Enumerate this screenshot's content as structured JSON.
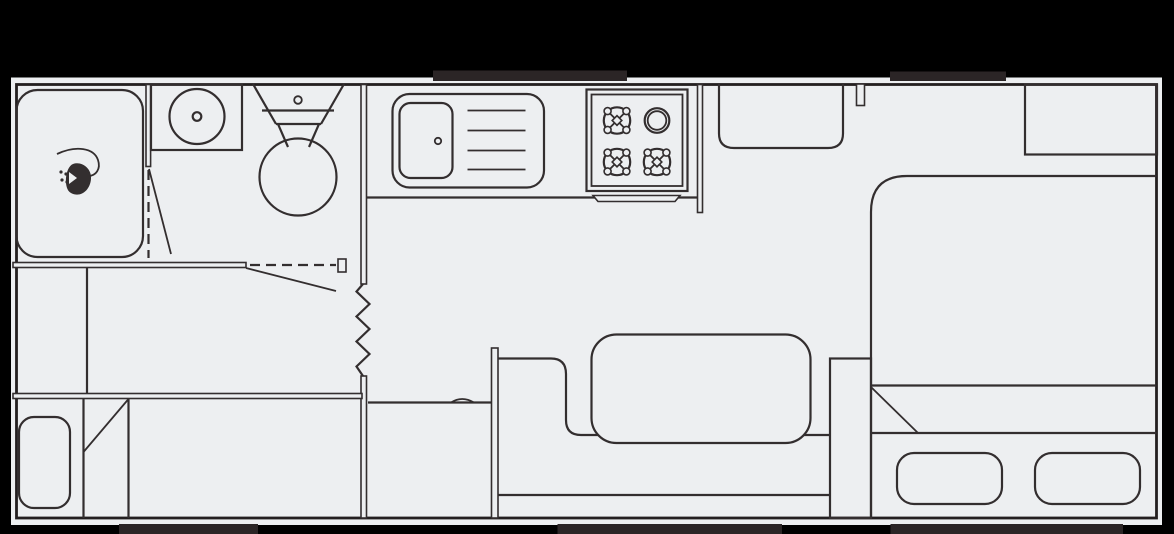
{
  "diagram": {
    "kind": "travel-trailer-floor-plan",
    "orientation": "side-view-top-down",
    "slide_markers": {
      "top_count": 2,
      "bottom_count": 3
    }
  },
  "colors": {
    "background": "#000000",
    "floor": "#edeff1",
    "line": "#332e2f",
    "wall": "#231f20",
    "marker": "#2b2526"
  },
  "fixtures": [
    {
      "name": "shower",
      "icon": "shower-head-icon",
      "area": "front-bathroom"
    },
    {
      "name": "bathroom-sink",
      "icon": "round-basin-icon",
      "area": "front-bathroom"
    },
    {
      "name": "toilet",
      "icon": "toilet-icon",
      "area": "front-bathroom"
    },
    {
      "name": "accordion-door",
      "icon": "zigzag-door-icon",
      "area": "hallway"
    },
    {
      "name": "pocket-door",
      "icon": "dashed-door-icon",
      "area": "front-bedroom"
    },
    {
      "name": "kitchen-sink-with-drainboard",
      "icon": "sink-icon",
      "area": "kitchen"
    },
    {
      "name": "cooktop",
      "icon": "gas-burner-icon",
      "burners": 4,
      "area": "kitchen"
    },
    {
      "name": "refrigerator",
      "icon": "fridge-icon",
      "area": "kitchen"
    },
    {
      "name": "entry-door-stub",
      "icon": "door-jamb-icon",
      "area": "main-room"
    },
    {
      "name": "sofa",
      "icon": "sofa-cushion-icon",
      "area": "main-room"
    },
    {
      "name": "wardrobe",
      "icon": "cabinet-icon",
      "area": "main-room"
    },
    {
      "name": "overhead-cabinet",
      "icon": "cabinet-icon",
      "area": "rear-bedroom"
    },
    {
      "name": "bed",
      "icon": "mattress-icon",
      "pillows": 2,
      "area": "rear-bedroom"
    },
    {
      "name": "nightstand",
      "icon": "cabinet-icon",
      "area": "rear-bedroom"
    },
    {
      "name": "bunk",
      "icon": "mattress-icon",
      "pillows": 1,
      "area": "front-bunk-room"
    }
  ]
}
